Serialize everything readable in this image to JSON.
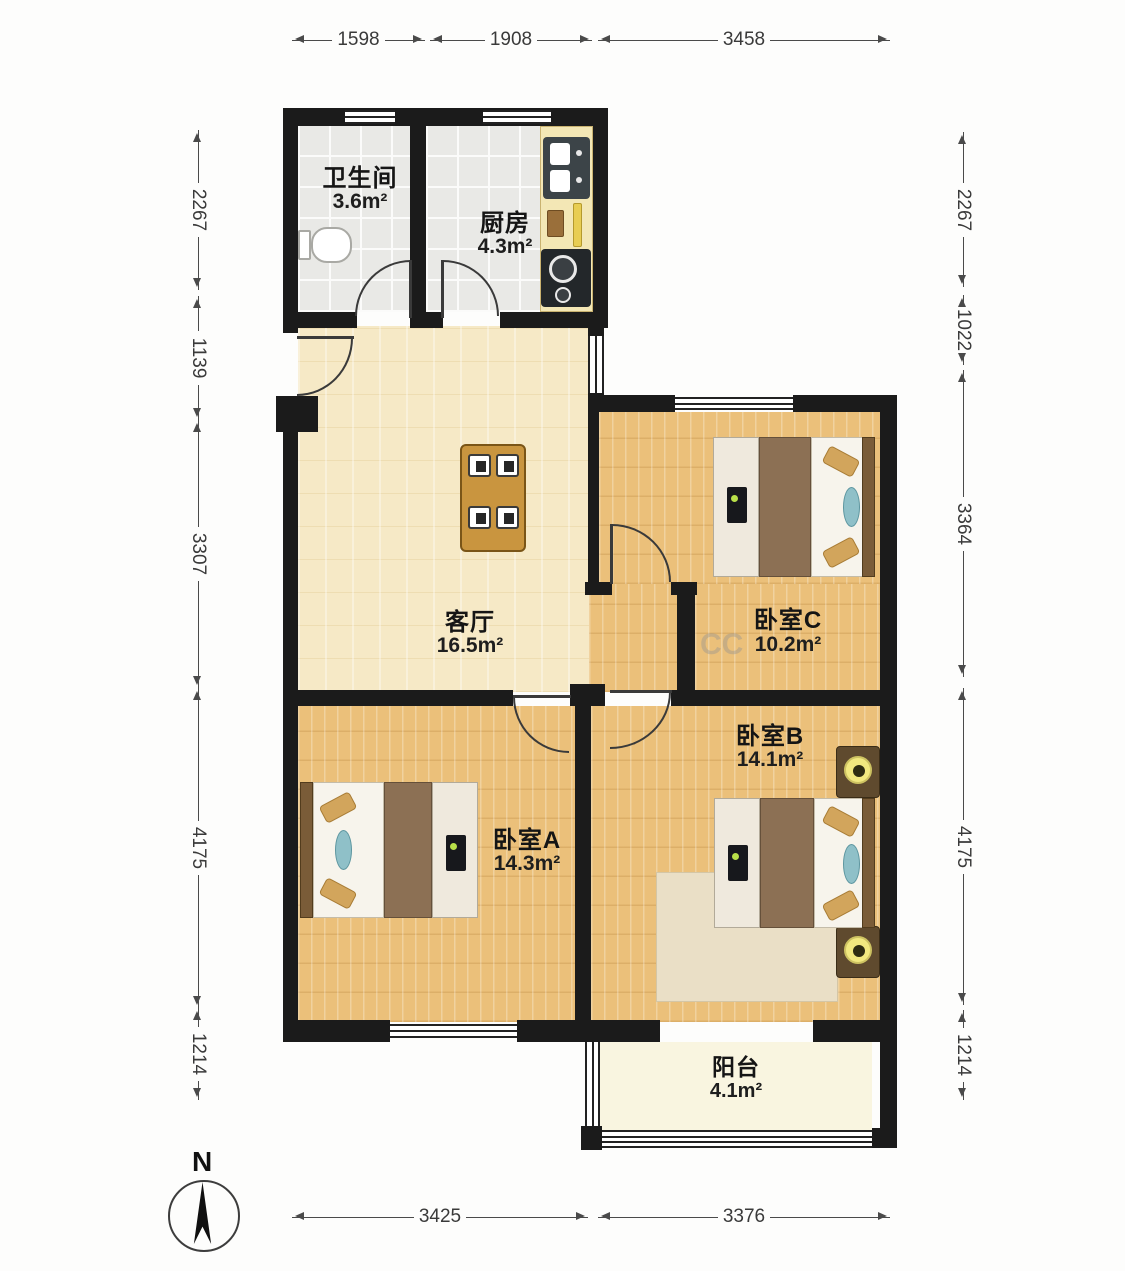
{
  "plan": {
    "rooms": {
      "bathroom": {
        "name": "卫生间",
        "area": "3.6m²"
      },
      "kitchen": {
        "name": "厨房",
        "area": "4.3m²"
      },
      "living_room": {
        "name": "客厅",
        "area": "16.5m²"
      },
      "bedroom_c": {
        "name": "卧室C",
        "area": "10.2m²"
      },
      "bedroom_b": {
        "name": "卧室B",
        "area": "14.1m²"
      },
      "bedroom_a": {
        "name": "卧室A",
        "area": "14.3m²"
      },
      "balcony": {
        "name": "阳台",
        "area": "4.1m²"
      }
    },
    "compass": {
      "label": "N"
    },
    "watermark": "CC"
  },
  "dims": {
    "top": [
      "1598",
      "1908",
      "3458"
    ],
    "bottom": [
      "3425",
      "3376"
    ],
    "left": [
      "2267",
      "1139",
      "3307",
      "4175",
      "1214"
    ],
    "right": [
      "2267",
      "1022",
      "3364",
      "4175",
      "1214"
    ]
  },
  "colors": {
    "wall": "#1b1b1b",
    "wood_floor": "#ebc07a",
    "living_floor": "#f6e9c6",
    "tile_floor": "#e9e9e6",
    "balcony_floor": "#f9f5e0",
    "counter": "#f3e7b5",
    "blanket": "#8c7054",
    "pillow": "#d2a55c",
    "pillow_accent": "#8fc0c8",
    "table": "#c9953f",
    "dimension_text": "#3a3a3a"
  }
}
